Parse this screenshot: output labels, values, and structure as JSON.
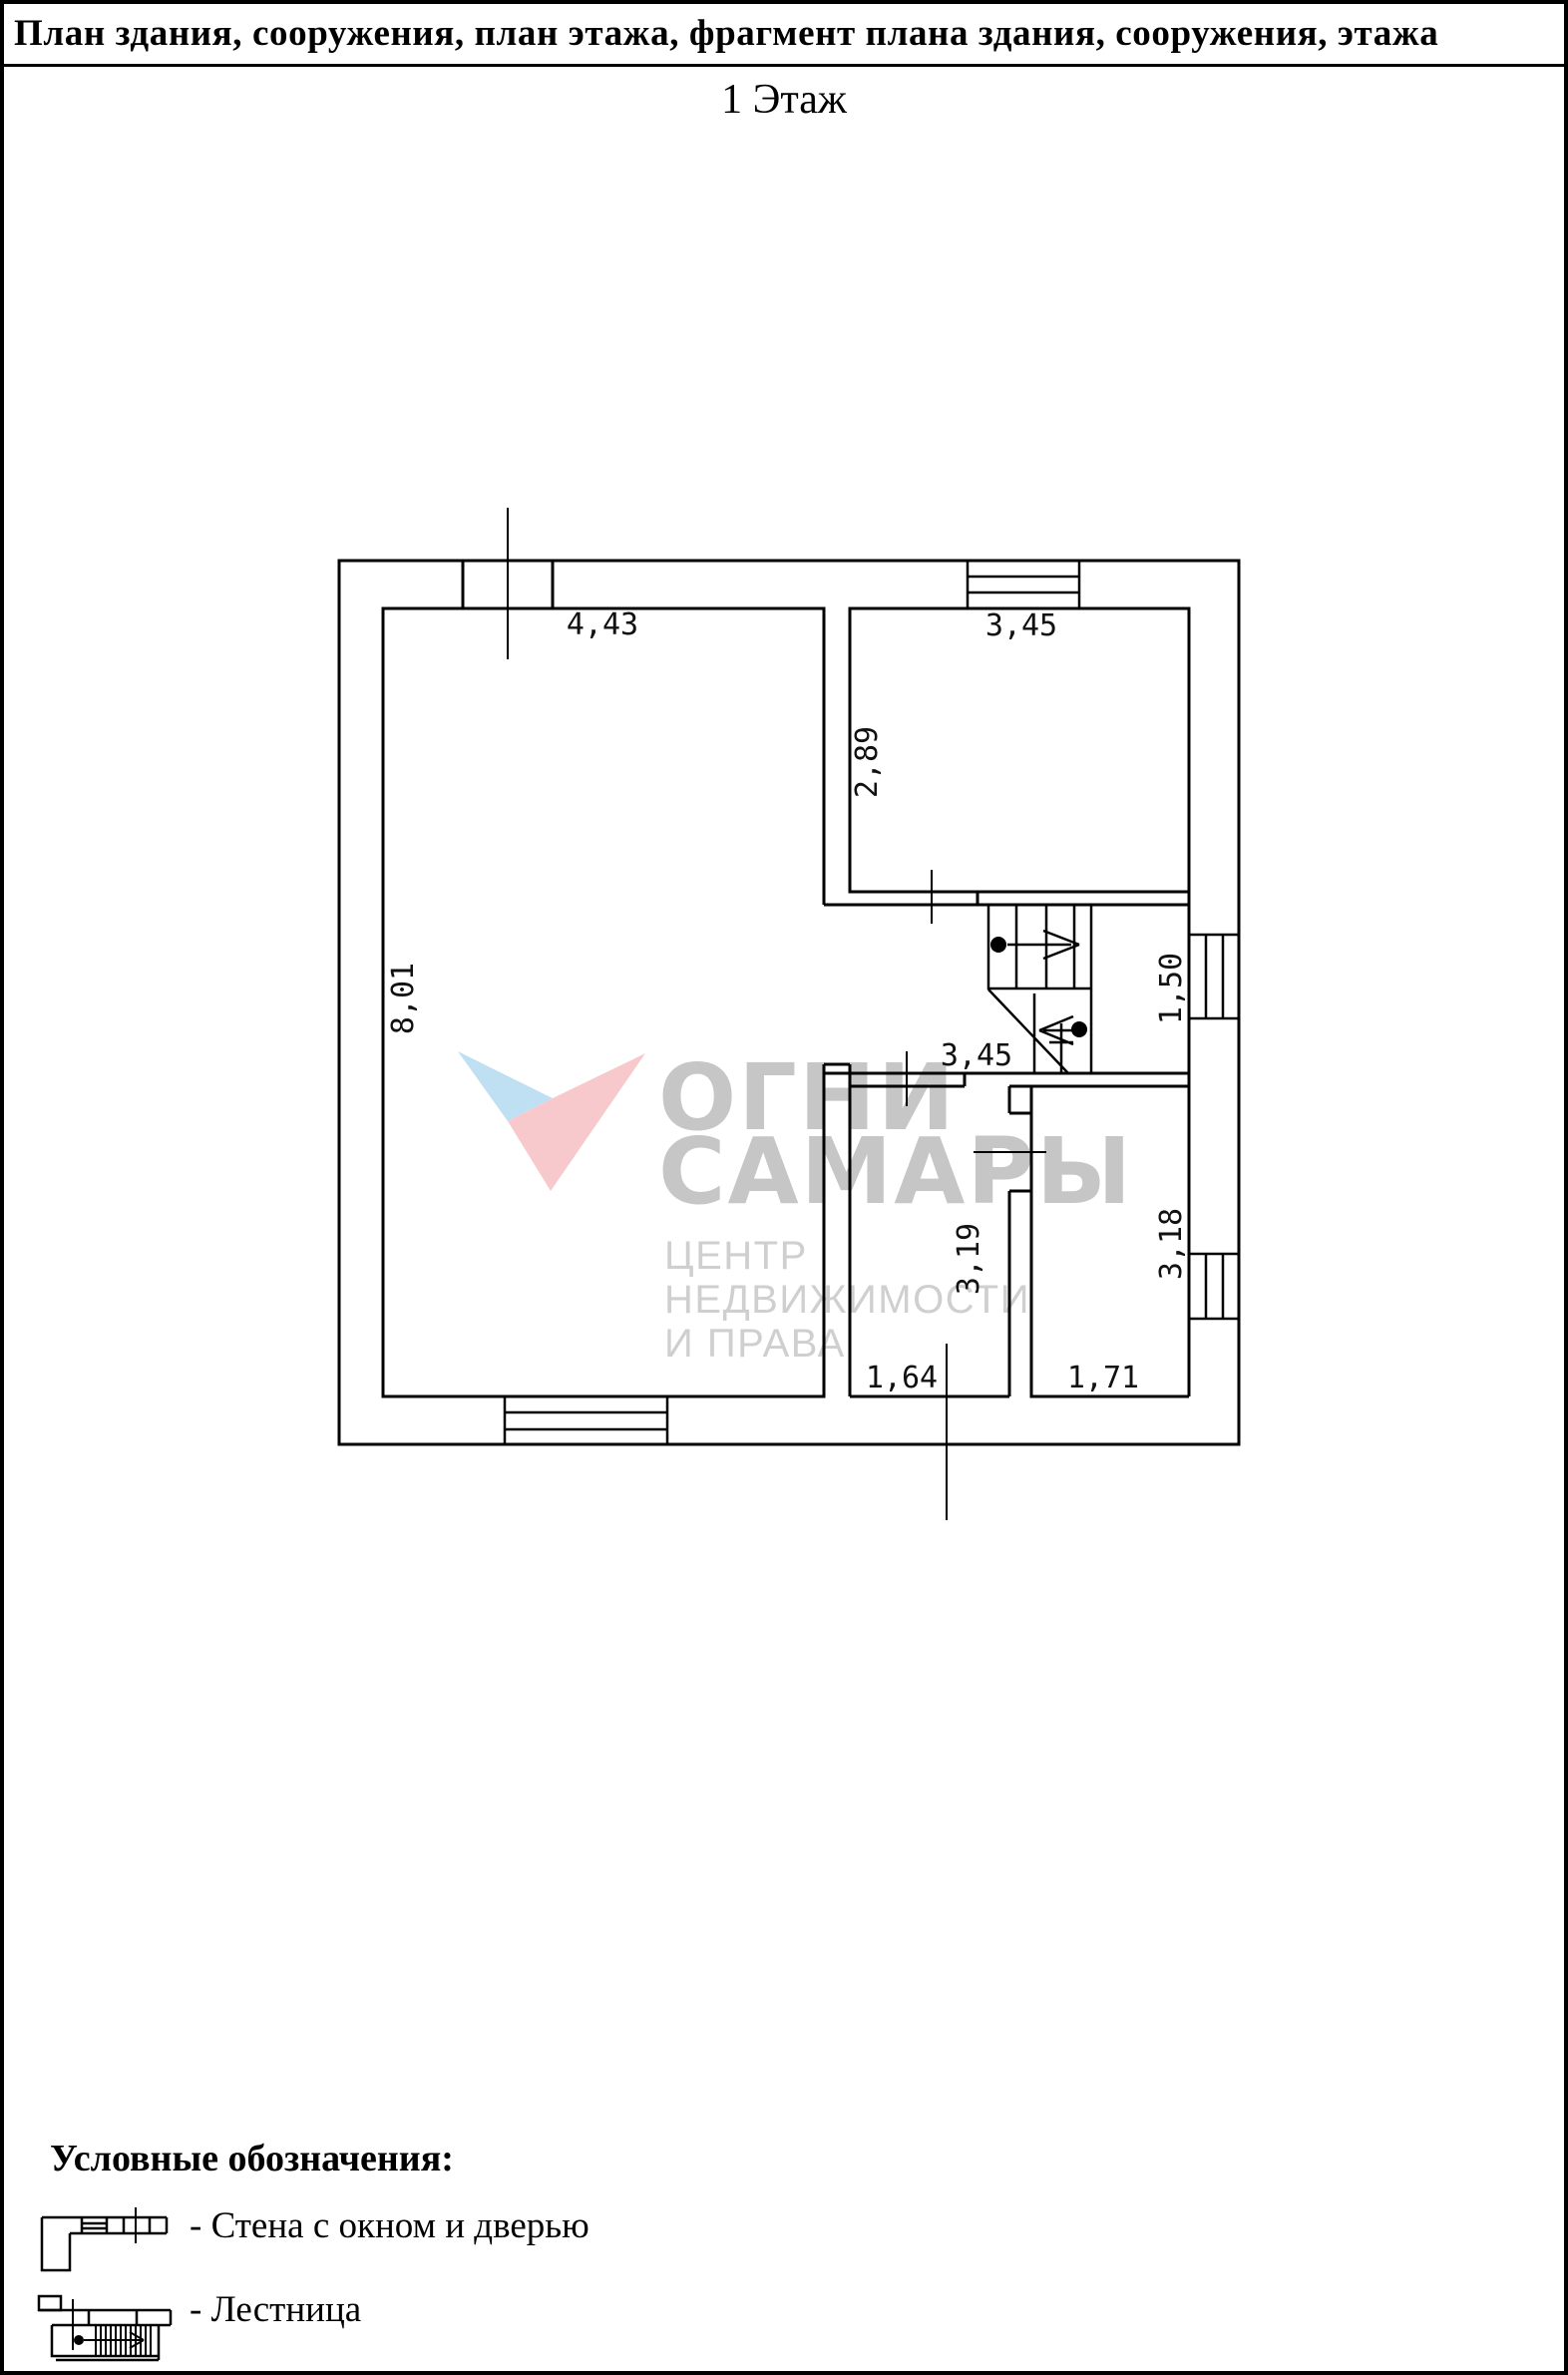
{
  "page": {
    "title": "План здания, сооружения, план этажа, фрагмент плана здания, сооружения, этажа",
    "subtitle": "1 Этаж"
  },
  "plan": {
    "dims": {
      "top_door": "4,43",
      "top_room_width": "3,45",
      "top_room_height": "2,89",
      "left_height": "8,01",
      "landing_width": "1,50",
      "hall_width": "3,45",
      "room_a_height": "3,19",
      "room_a_width": "1,64",
      "room_b_height": "3,18",
      "room_b_width": "1,71"
    }
  },
  "watermark": {
    "brand1": "ОГНИ",
    "brand2": "САМАРЫ",
    "tag1": "ЦЕНТР",
    "tag2": "НЕДВИЖИМОСТИ",
    "tag3": "И ПРАВА",
    "colors": {
      "logo_blue": "#bfe0f2",
      "logo_pink": "#f8c9cc",
      "brand_gray": "#c6c6c6",
      "tag_gray": "#cfcfcf"
    }
  },
  "legend": {
    "heading": "Условные обозначения:",
    "items": [
      {
        "label": "- Стена с окном и дверью"
      },
      {
        "label": "- Лестница"
      }
    ]
  }
}
